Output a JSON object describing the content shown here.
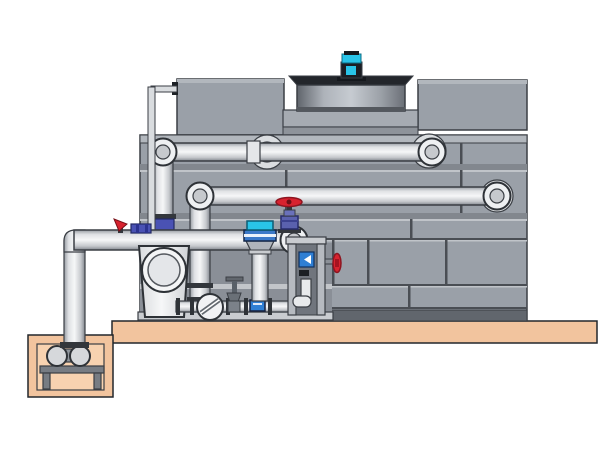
{
  "scene": {
    "description": "Technical illustration of a cooling tower with rooftop fan motor, external supply and return piping, a pump skid with valves, and a sump pit pump on a concrete slab",
    "background": "#ffffff"
  },
  "palette": {
    "tower_gray": "#9aa0a8",
    "panel_seam": "#4a4e54",
    "tower_base": "#61666d",
    "slab_tan": "#f2c49e",
    "pit_tan": "#f7d2b0",
    "motor_cyan": "#29c4e8",
    "motor_dark": "#1b1e24",
    "pump_blue": "#3b79c9",
    "valve_red": "#d8232f",
    "valve_purple": "#5a61ae",
    "valve_indigo": "#4a52b4",
    "label_blue": "#2f7fd4",
    "pipe_highlight": "#f6f7f8",
    "frame_gray": "#c6c9cd"
  },
  "components": [
    {
      "id": "cooling-tower-shell",
      "kind": "casing"
    },
    {
      "id": "fan-cowl",
      "kind": "fan shroud"
    },
    {
      "id": "fan-motor",
      "kind": "motor"
    },
    {
      "id": "upper-supply-pipe",
      "kind": "pipe"
    },
    {
      "id": "middle-return-pipe",
      "kind": "pipe"
    },
    {
      "id": "lower-suction-pipe",
      "kind": "pipe"
    },
    {
      "id": "overflow-line",
      "kind": "small pipe"
    },
    {
      "id": "inline-separator",
      "kind": "vessel"
    },
    {
      "id": "vertical-pump",
      "kind": "pump"
    },
    {
      "id": "globe-valve-red-handwheel",
      "kind": "valve"
    },
    {
      "id": "butterfly-valve",
      "kind": "valve"
    },
    {
      "id": "check-valve",
      "kind": "valve"
    },
    {
      "id": "gate-valve",
      "kind": "valve"
    },
    {
      "id": "drain-lever-valve",
      "kind": "valve"
    },
    {
      "id": "control-stand",
      "kind": "frame"
    },
    {
      "id": "sump-pit",
      "kind": "concrete pit"
    },
    {
      "id": "sump-pump",
      "kind": "pump"
    },
    {
      "id": "concrete-slab",
      "kind": "foundation"
    }
  ]
}
